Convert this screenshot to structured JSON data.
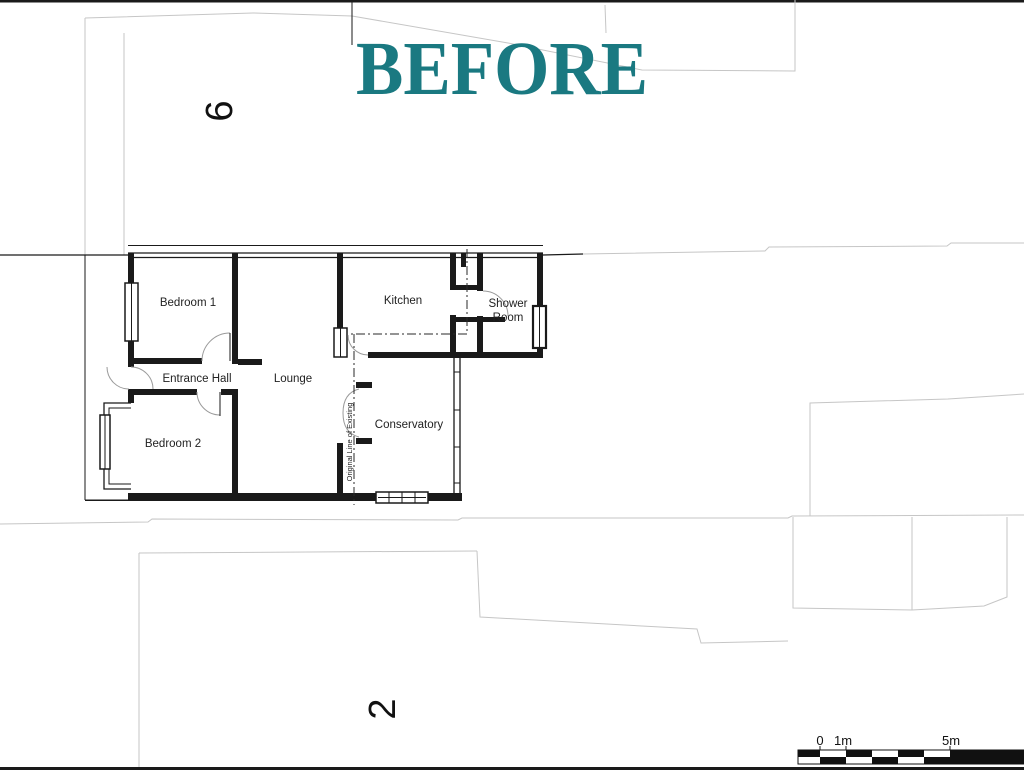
{
  "title": "BEFORE",
  "plots": {
    "plot_top": "6",
    "plot_bottom": "2"
  },
  "rooms": {
    "bedroom1": "Bedroom 1",
    "entrance_hall": "Entrance Hall",
    "bedroom2": "Bedroom 2",
    "lounge": "Lounge",
    "kitchen": "Kitchen",
    "shower_room_line1": "Shower",
    "shower_room_line2": "Room",
    "conservatory": "Conservatory"
  },
  "annotations": {
    "original_line": "Original Line of Existing"
  },
  "scale_bar": {
    "tick0": "0",
    "tick1m": "1m",
    "tick5m": "5m"
  },
  "colors": {
    "title_teal": "#1a7981",
    "plan_ink": "#1a1a1a",
    "site_line_gray": "#c6c6c6",
    "door_arc_gray": "#9a9a9a"
  }
}
